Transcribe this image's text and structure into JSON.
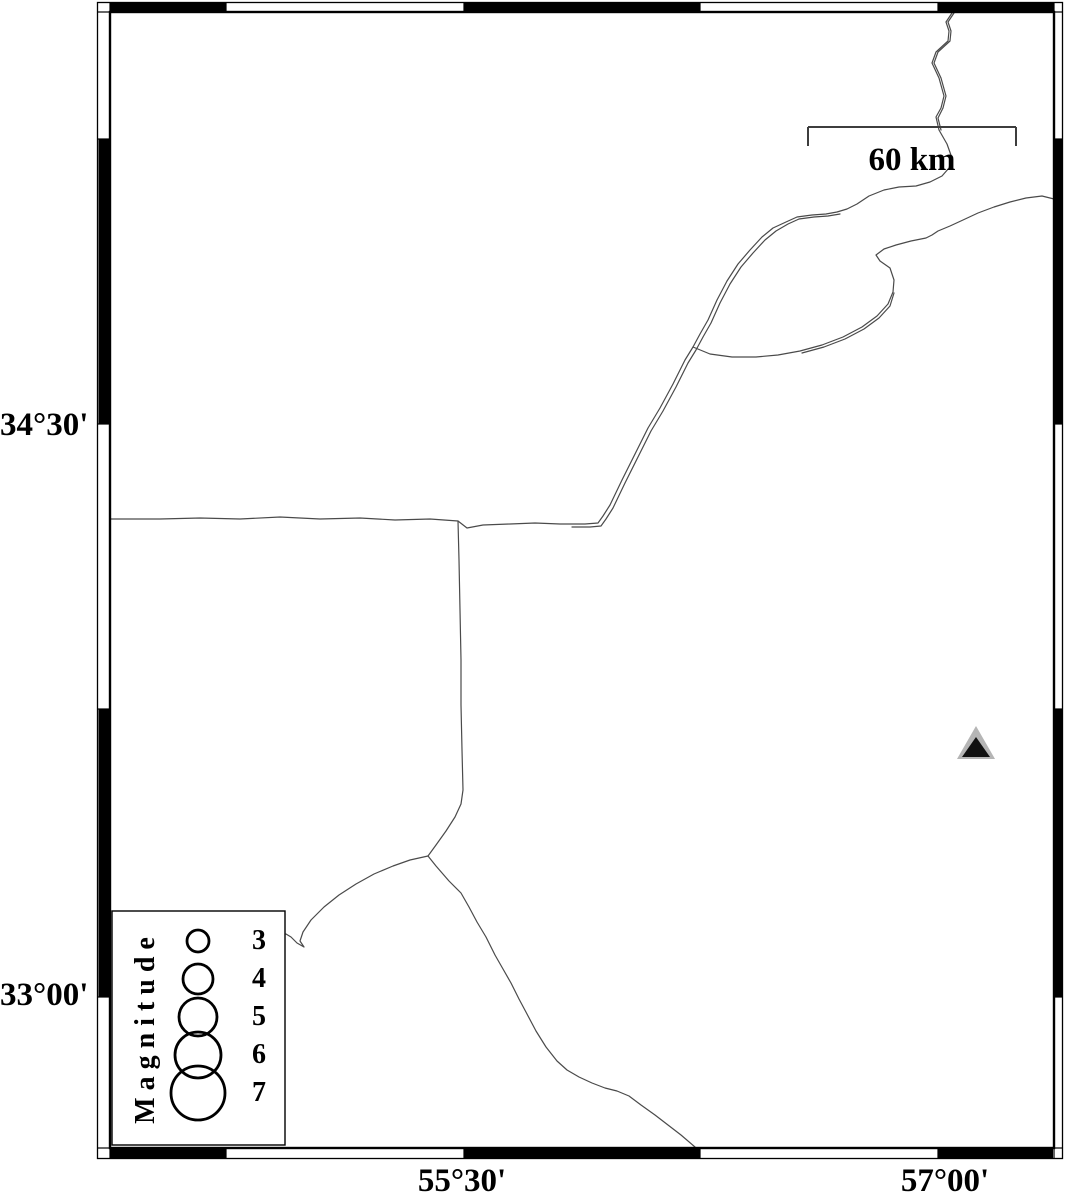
{
  "figure": {
    "kind": "seismic-station-map",
    "background": "#ffffff"
  },
  "frame": {
    "color": "#000000",
    "lat": [
      {
        "label": "34°30'"
      },
      {
        "label": "33°00'"
      }
    ],
    "lon": [
      {
        "label": "55°30'"
      },
      {
        "label": "57°00'"
      }
    ]
  },
  "scalebar": {
    "label": "60 km",
    "color": "#3d3d3d"
  },
  "legend": {
    "title": "Magnitude",
    "items": [
      {
        "label": "3",
        "radius": 11
      },
      {
        "label": "4",
        "radius": 15
      },
      {
        "label": "5",
        "radius": 19
      },
      {
        "label": "6",
        "radius": 23
      },
      {
        "label": "7",
        "radius": 27
      }
    ]
  },
  "markers": {
    "station": {
      "shape": "triangle",
      "outer_color": "#b5b5b5",
      "inner_color": "#111111"
    }
  },
  "roads": {
    "color": "#4a4a4a"
  }
}
